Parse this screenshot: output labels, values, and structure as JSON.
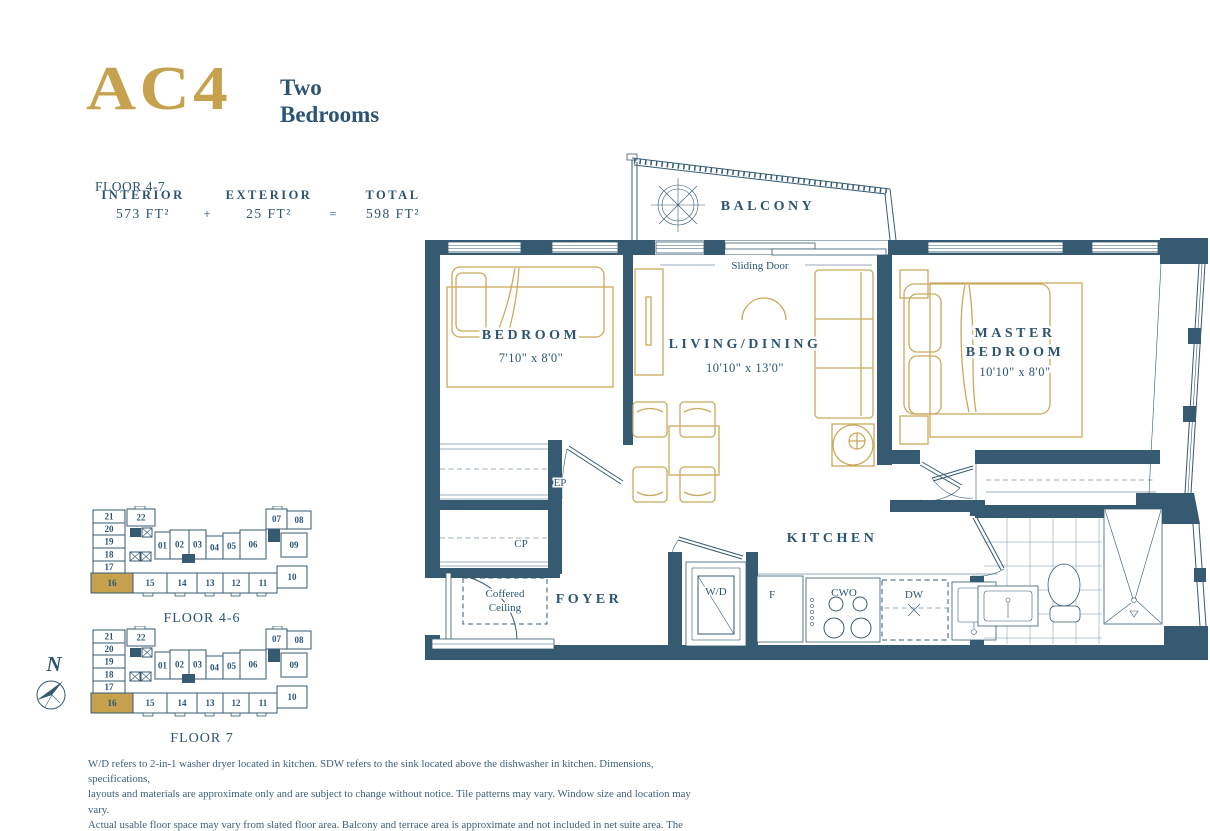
{
  "colors": {
    "navy": "#355A72",
    "navy_text": "#2D5472",
    "gold": "#C6A24E",
    "gold_line": "#CBA95C"
  },
  "header": {
    "unit_code": "AC4",
    "type_line1": "Two",
    "type_line2": "Bedrooms",
    "floor_range": "FLOOR 4-7",
    "area": {
      "interior_label": "INTERIOR",
      "exterior_label": "EXTERIOR",
      "total_label": "TOTAL",
      "interior_value": "573 FT²",
      "plus": "+",
      "exterior_value": "25 FT²",
      "equals": "=",
      "total_value": "598 FT²"
    }
  },
  "plan": {
    "balcony": "BALCONY",
    "sliding_door": "Sliding Door",
    "bedroom": {
      "name": "BEDROOM",
      "dims": "7'10\" x 8'0\""
    },
    "living": {
      "name": "LIVING/DINING",
      "dims": "10'10\" x 13'0\""
    },
    "master": {
      "line1": "MASTER",
      "line2": "BEDROOM",
      "dims": "10'10\" x 8'0\""
    },
    "kitchen": "KITCHEN",
    "foyer": "FOYER",
    "coffered": {
      "line1": "Coffered",
      "line2": "Ceiling"
    },
    "fixtures": {
      "wd": "W/D",
      "fridge": "F",
      "cooktop": "CWO",
      "dishwasher": "DW",
      "entry_closet": "EP",
      "coat_closet": "CP"
    }
  },
  "keyplans": [
    {
      "label": "FLOOR 4-6",
      "highlight": "16",
      "units": [
        "21",
        "20",
        "19",
        "18",
        "17",
        "16",
        "15",
        "14",
        "13",
        "12",
        "11",
        "10",
        "22",
        "01",
        "02",
        "03",
        "04",
        "05",
        "06",
        "07",
        "08",
        "09"
      ]
    },
    {
      "label": "FLOOR 7",
      "highlight": "16",
      "units": [
        "21",
        "20",
        "19",
        "18",
        "17",
        "16",
        "15",
        "14",
        "13",
        "12",
        "11",
        "10",
        "22",
        "01",
        "02",
        "03",
        "04",
        "05",
        "06",
        "07",
        "08",
        "09"
      ]
    }
  ],
  "north_label": "N",
  "disclaimer": {
    "lines": [
      "W/D refers to 2-in-1 washer dryer located in kitchen. SDW refers to the sink located above the dishwasher in kitchen. Dimensions, specifications,",
      "layouts and materials are approximate only and are subject to change without notice. Tile patterns may vary. Window size and location may vary.",
      "Actual usable floor space may vary from slated floor area. Balcony and terrace area is approximate and not included in net suite area. The purchaser",
      "acknowledges that the actual unit purchased may be a reverse layout to the plan shown. See Sales Representative for full details. E. & O. E."
    ]
  }
}
